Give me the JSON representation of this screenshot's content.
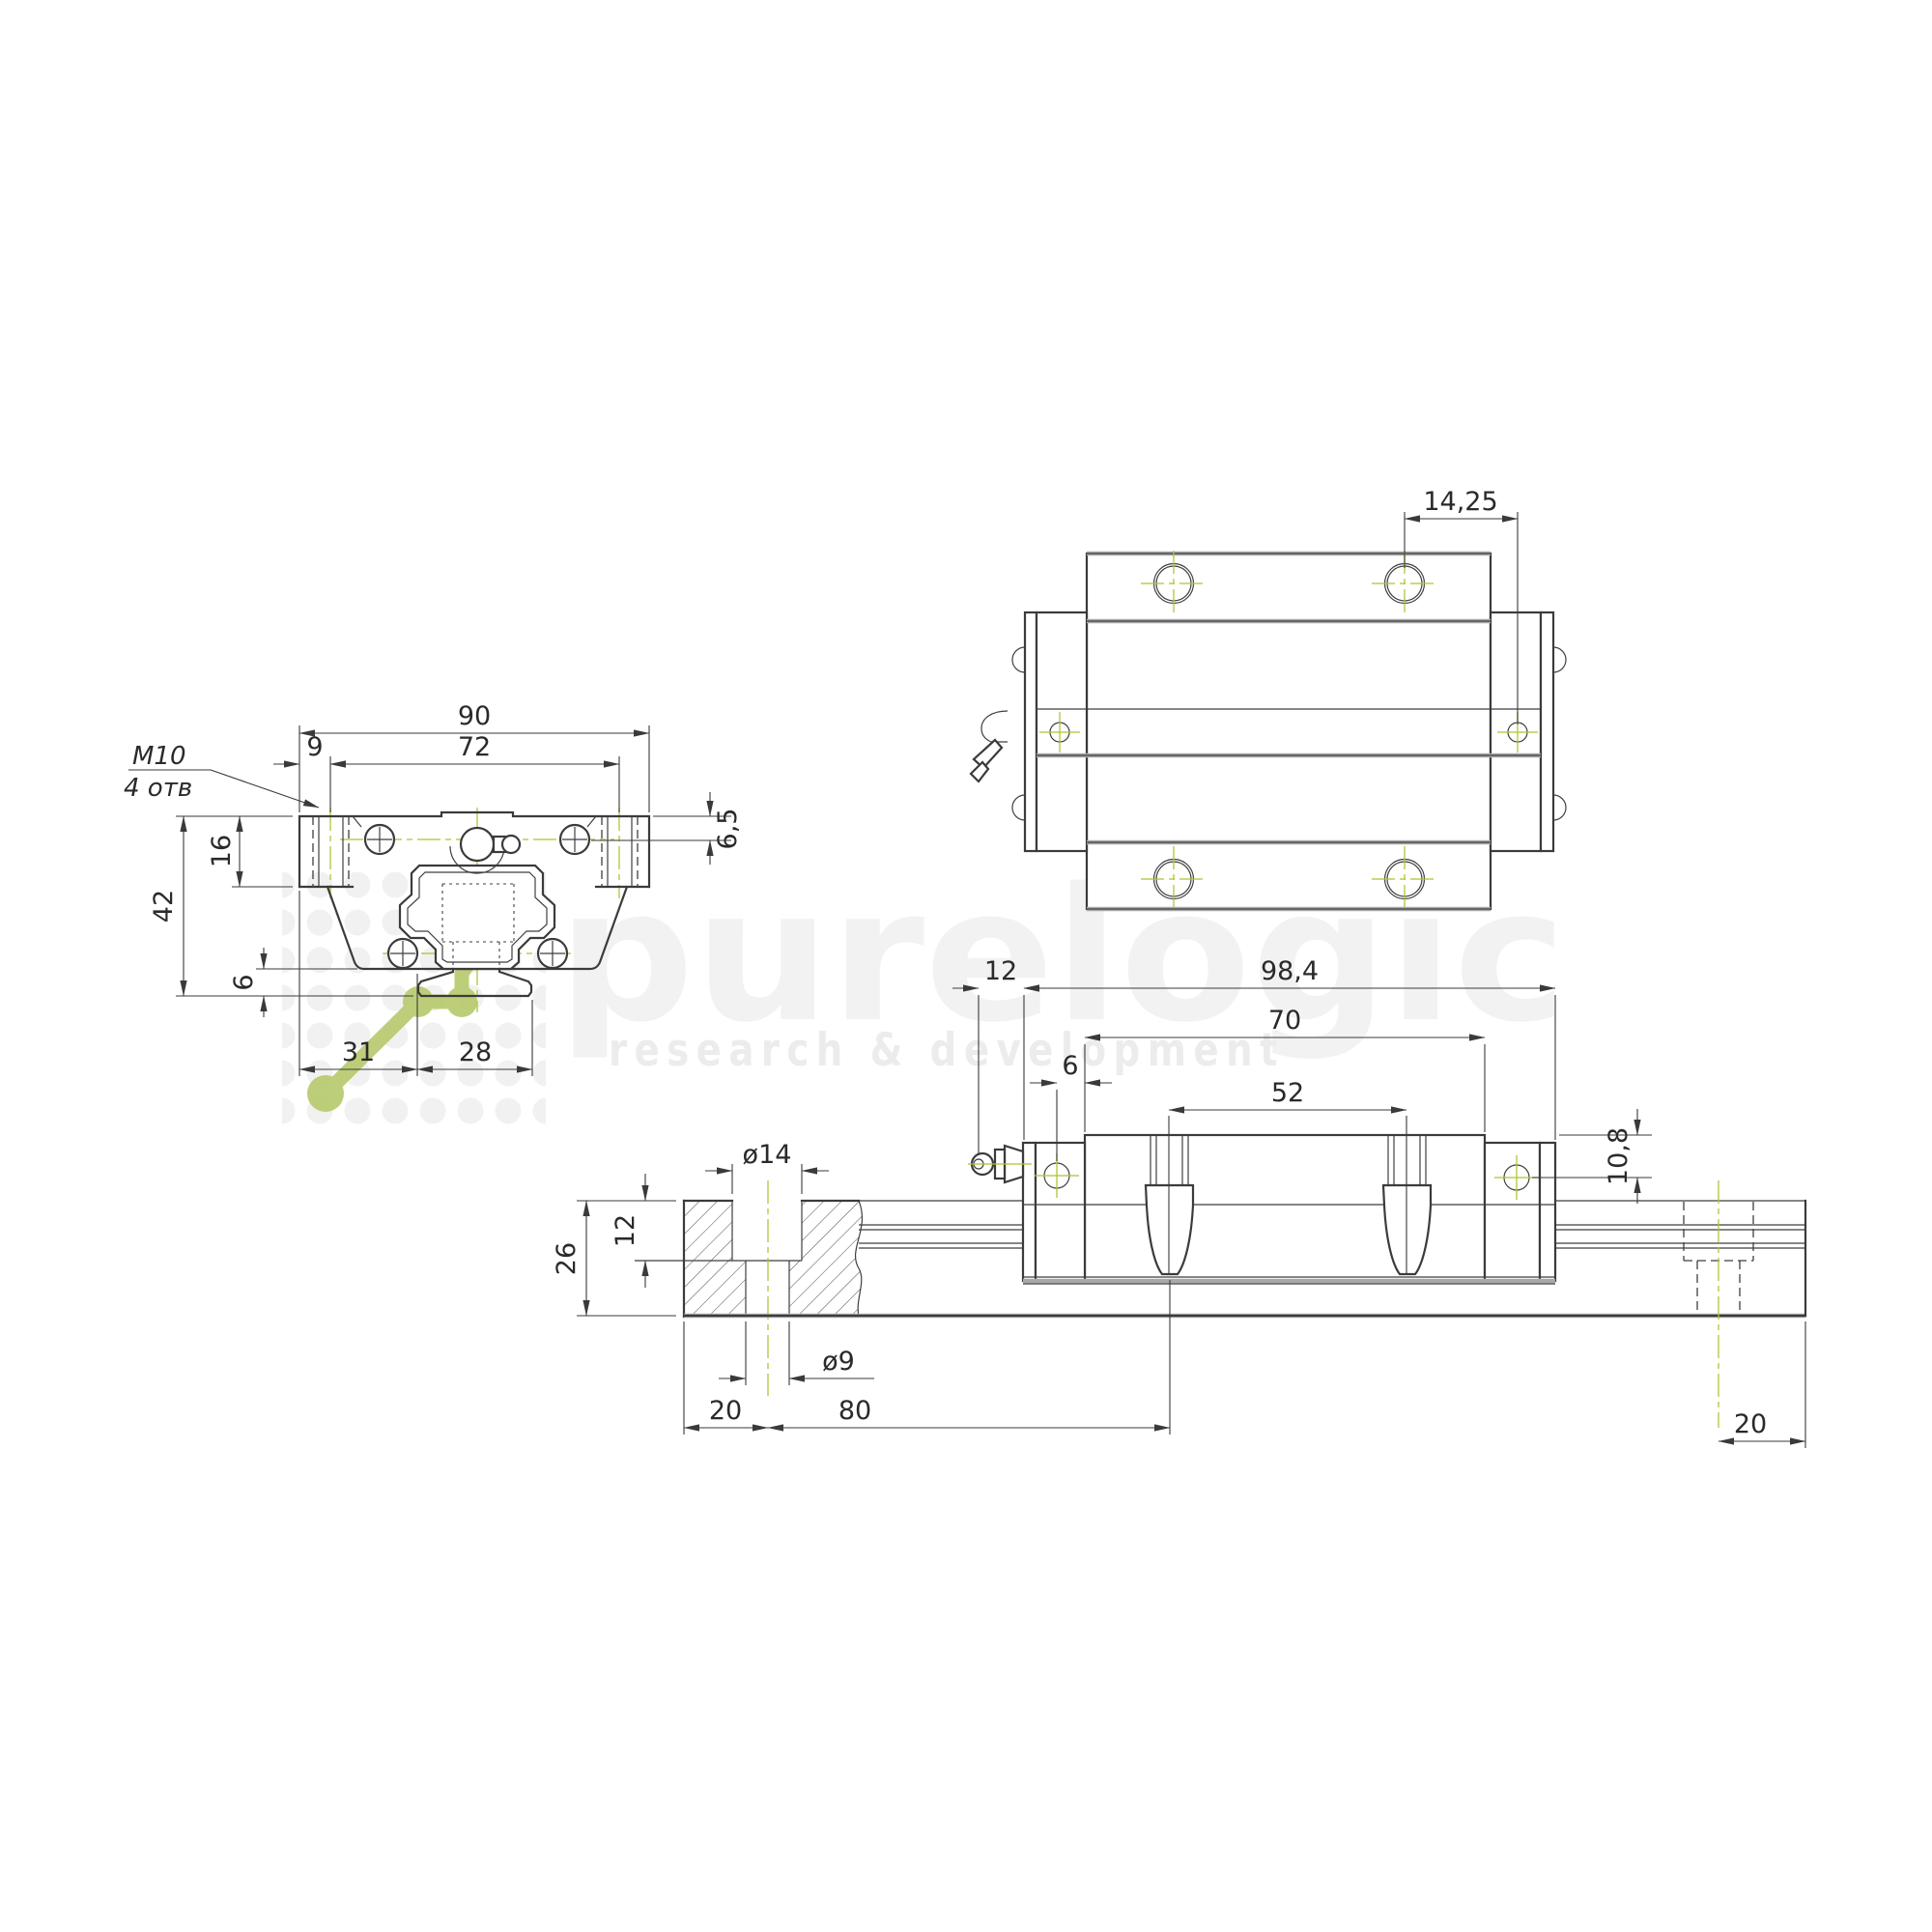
{
  "watermark": {
    "wordmark": "purelogic",
    "tagline": "research & development",
    "accent_color": "#b7ca6e",
    "letter_color": "#f2f2f2"
  },
  "colors": {
    "line": "#3b3b3b",
    "centerline_green": "#aec531",
    "background": "#ffffff"
  },
  "front_view": {
    "total_width": "90",
    "hole_edge_offset": "9",
    "hole_spacing": "72",
    "thread_label": "M10",
    "thread_note": "4 отв",
    "flange_height": "16",
    "total_height": "42",
    "bottom_clearance": "6",
    "hole_center_depth": "6,5",
    "edge_to_rail": "31",
    "rail_width": "28"
  },
  "top_view": {
    "hole_to_cap": "14,25"
  },
  "side_view": {
    "nipple_protrusion": "12",
    "total_length": "98,4",
    "body_length": "70",
    "port_offset": "6",
    "hole_pitch_block": "52",
    "port_center_depth": "10,8",
    "rail_height": "26",
    "counterbore_depth": "12",
    "counterbore_dia": "ø14",
    "bolt_hole_dia": "ø9",
    "rail_end_to_hole_left": "20",
    "rail_hole_pitch": "80",
    "rail_end_to_hole_right": "20"
  }
}
